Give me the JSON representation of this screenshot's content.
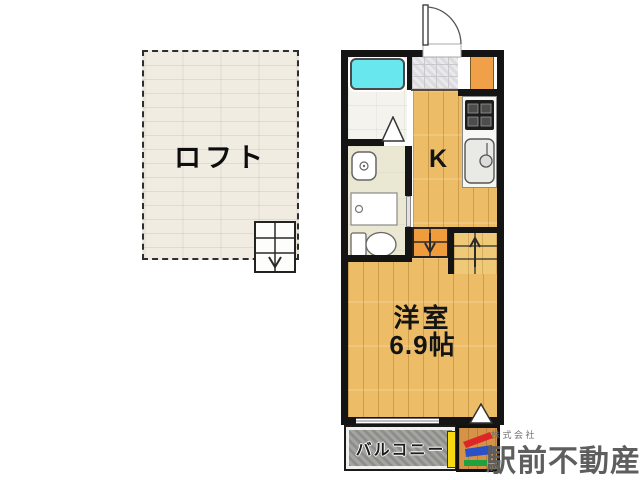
{
  "floorplan": {
    "loft": {
      "label": "ロフト"
    },
    "kitchen": {
      "label": "K"
    },
    "western_room": {
      "name": "洋室",
      "size": "6.9帖"
    },
    "balcony": {
      "label": "バルコニー"
    }
  },
  "branding": {
    "company_prefix": "株式会社",
    "company_name": "駅前不動産"
  },
  "colors": {
    "wall": "#141414",
    "bathtub": "#68e7ee",
    "wood_floor": "#ecbd66",
    "loft_floor": "#efe9de",
    "washroom_floor": "#eae8d3",
    "entry_tiles": "#eaeaed",
    "step_block": "#f09c3c",
    "shoe_cabinet": "#efa049",
    "balcony": "#9d9d99",
    "logo_red": "#dd2627",
    "logo_blue": "#2b50c8",
    "logo_green": "#1fa23e",
    "logo_yellow": "#f6d90f",
    "company_text": "#5e5e5e"
  },
  "icons": {
    "entrance-door-icon": "quarter-arc-swing",
    "bathtub-icon": "rounded-rect",
    "bath-door-triangle-icon": "triangle-up",
    "washbasin-icon": "bowl-with-drain",
    "washing-machine-icon": "pan-with-drain",
    "toilet-icon": "tank-and-bowl",
    "stove-icon": "burner-grid",
    "kitchen-sink-icon": "basin-with-faucet",
    "step-down-icon": "treads-down-arrow",
    "stairs-up-icon": "treads-up-arrow",
    "loft-stairs-icon": "treads-down-arrow",
    "corner-triangle-icon": "triangle-up",
    "company-logo-icon": "red-blue-green-mark"
  }
}
